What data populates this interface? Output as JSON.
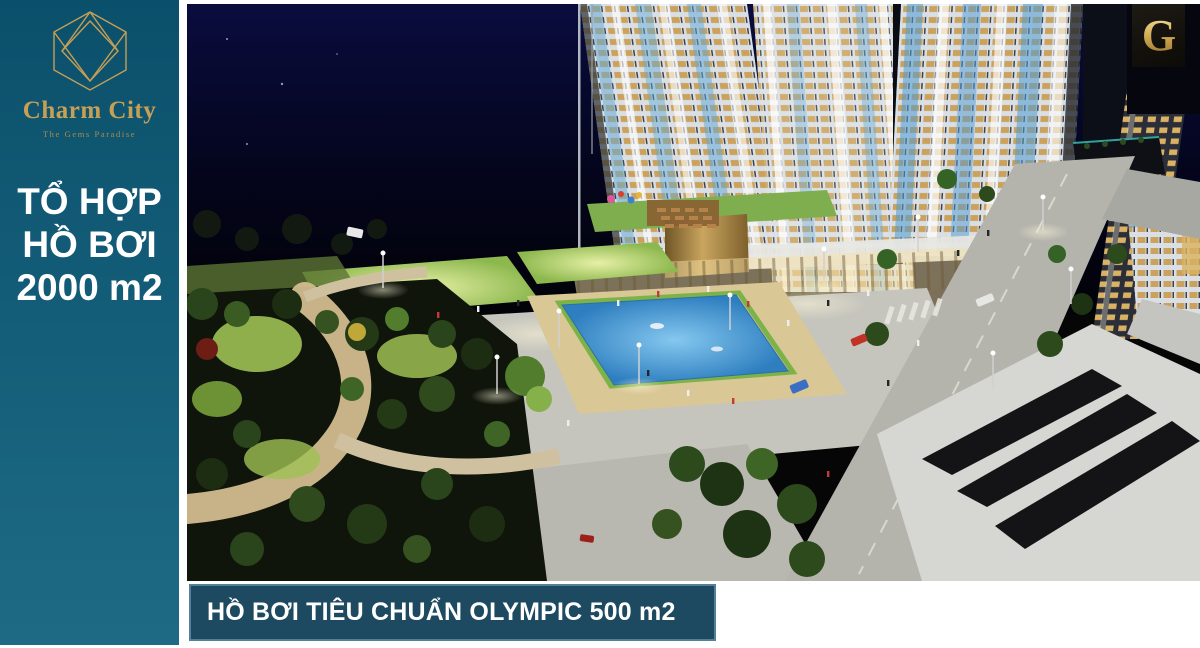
{
  "sidebar": {
    "brand": "Charm City",
    "tagline": "The Gems Paradise",
    "headline": {
      "line1": "TỔ HỢP",
      "line2": "HỒ BƠI",
      "line3": "2000 m2"
    }
  },
  "banner": {
    "text": "HỒ BƠI TIÊU CHUẨN OLYMPIC 500 m2"
  },
  "badge": {
    "letter": "G"
  },
  "colors": {
    "sidebar_teal_top": "#0b506b",
    "sidebar_teal_bottom": "#1e6a84",
    "gold": "#c79f55",
    "banner_navy": "#1d4a61",
    "banner_border": "#54809a",
    "pool_blue": "#4796d2",
    "lawn_green": "#9dc054"
  }
}
